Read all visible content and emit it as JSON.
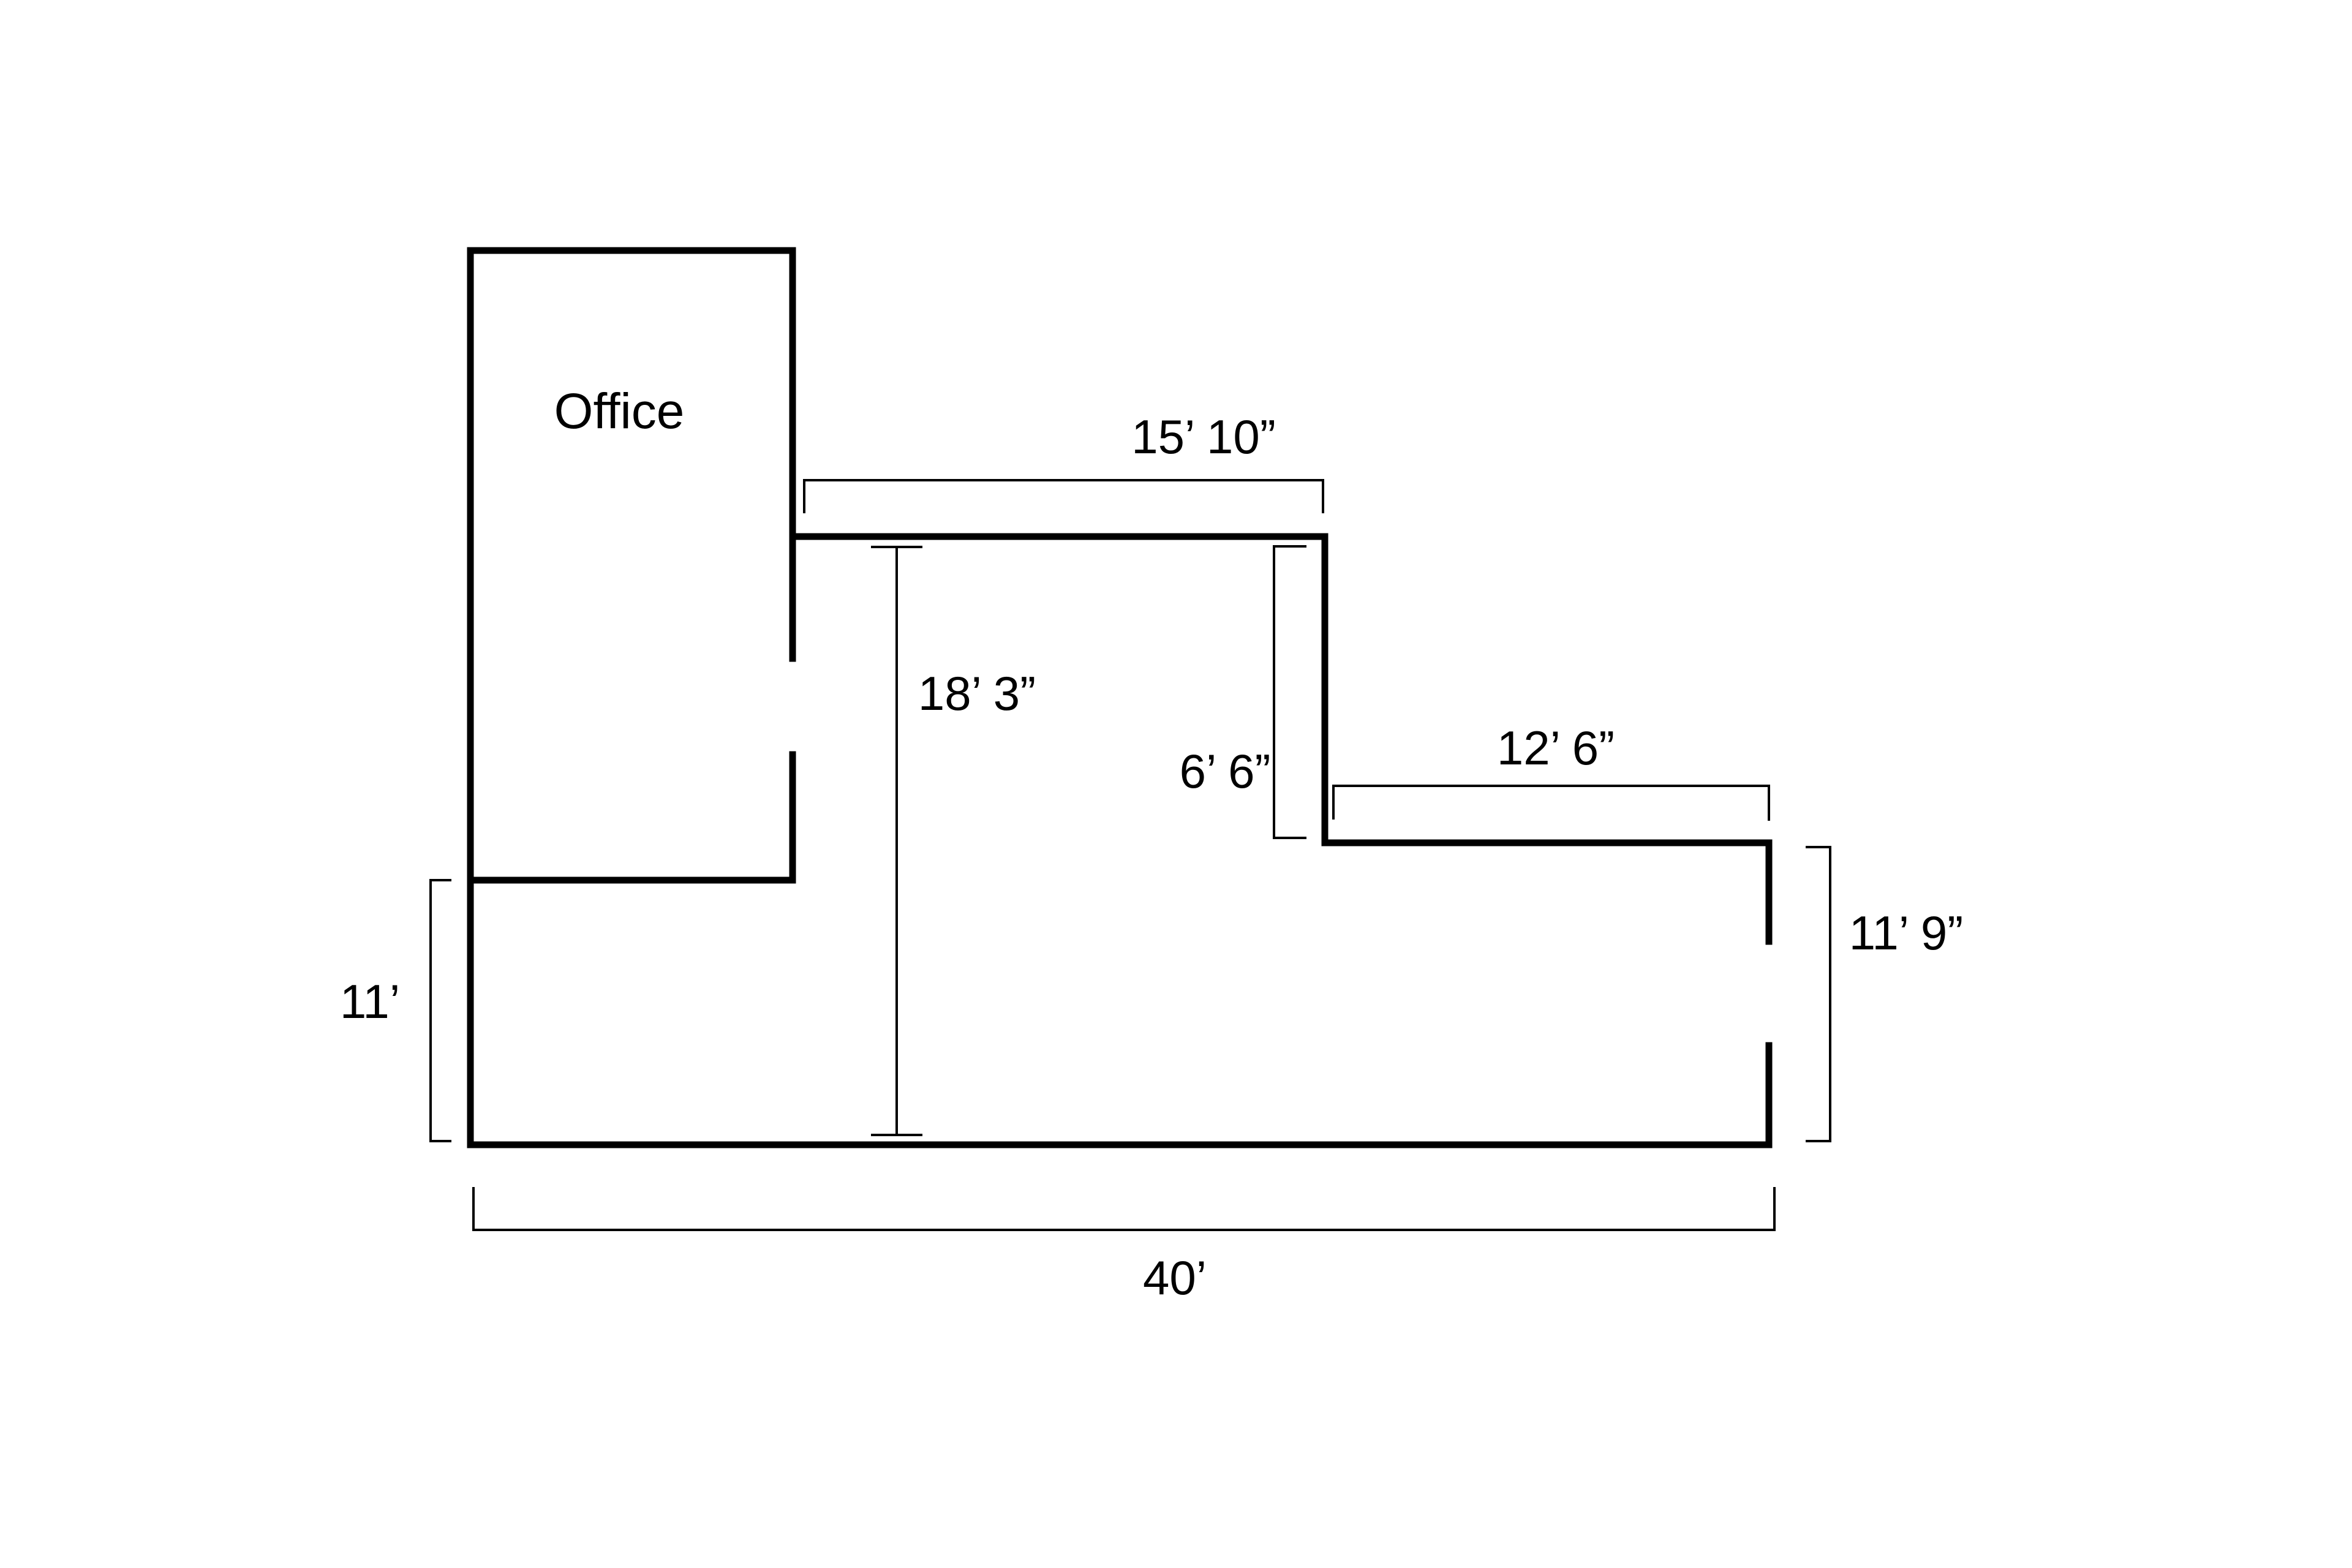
{
  "room": {
    "label": "Office"
  },
  "dimensions": {
    "top_width": "15’ 10”",
    "interior_height": "18’ 3”",
    "step_height": "6’ 6”",
    "ledge_width": "12’ 6”",
    "right_height": "11’ 9”",
    "left_height": "11’",
    "total_width": "40’"
  },
  "colors": {
    "wall": "#000000",
    "dimension_line": "#000000",
    "text": "#000000",
    "background": "#ffffff"
  }
}
